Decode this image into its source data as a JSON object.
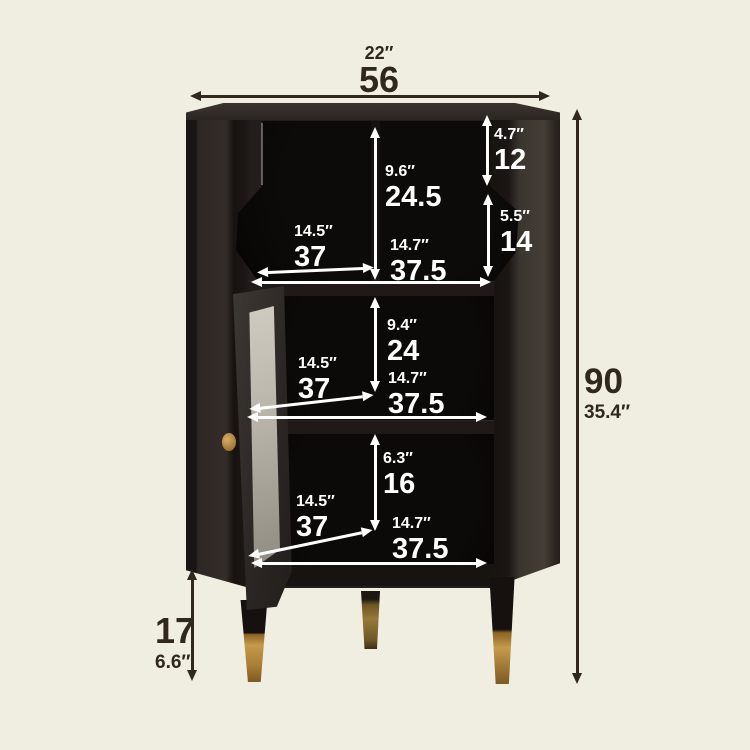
{
  "image": {
    "description": "Dimension diagram of a black corner display cabinet with an open glass door, open shelving and brass-tipped tapered legs; measurements given in centimeters (large) and inches (small)"
  },
  "colors": {
    "background": "#f0ede1",
    "cabinet_body": "#221d1b",
    "interior": "#0a0807",
    "brass_leg_tip": "#c59a4e",
    "glass_panel": "#b7b3a8",
    "annotation_light": "#ffffff",
    "annotation_dark": "#30271e"
  },
  "dimensions": {
    "top_width": {
      "in": "22″",
      "cm": "56"
    },
    "overall_height": {
      "cm": "90",
      "in": "35.4″"
    },
    "leg_height": {
      "cm": "17",
      "in": "6.6″"
    },
    "top_right_upper": {
      "in": "4.7″",
      "cm": "12"
    },
    "top_shelf_height": {
      "in": "9.6″",
      "cm": "24.5"
    },
    "top_right_lower": {
      "in": "5.5″",
      "cm": "14"
    },
    "top_shelf_depth": {
      "in": "14.5″",
      "cm": "37"
    },
    "top_shelf_width": {
      "in": "14.7″",
      "cm": "37.5"
    },
    "middle_shelf_height": {
      "in": "9.4″",
      "cm": "24"
    },
    "middle_shelf_depth": {
      "in": "14.5″",
      "cm": "37"
    },
    "middle_shelf_width": {
      "in": "14.7″",
      "cm": "37.5"
    },
    "bottom_shelf_height": {
      "in": "6.3″",
      "cm": "16"
    },
    "bottom_shelf_depth": {
      "in": "14.5″",
      "cm": "37"
    },
    "bottom_shelf_width": {
      "in": "14.7″",
      "cm": "37.5"
    }
  }
}
